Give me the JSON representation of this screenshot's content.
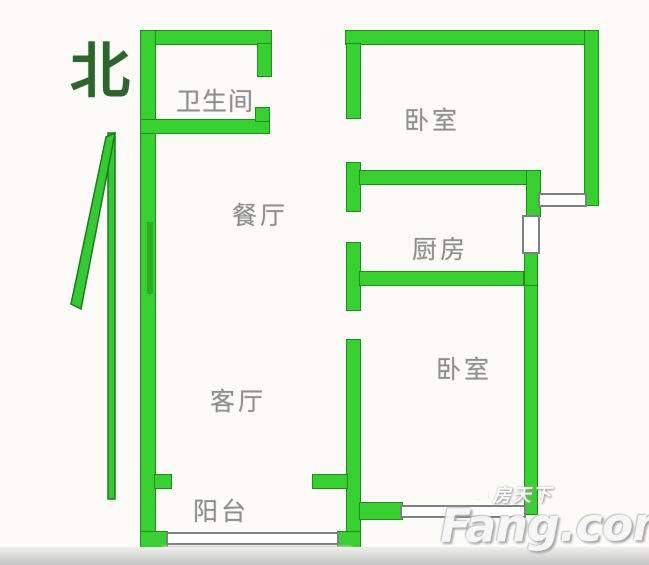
{
  "compass": {
    "north_label": "北"
  },
  "rooms": {
    "bathroom": {
      "label": "卫生间"
    },
    "bedroom_top": {
      "label": "卧室"
    },
    "dining": {
      "label": "餐厅"
    },
    "kitchen": {
      "label": "厨房"
    },
    "bedroom_bottom": {
      "label": "卧室"
    },
    "living": {
      "label": "客厅"
    },
    "balcony": {
      "label": "阳台"
    }
  },
  "watermark": {
    "brand_cn": "房天下",
    "brand_en": "Fang.com"
  },
  "colors": {
    "wall_fill": "#38cf31",
    "wall_edge": "#1f8c1f",
    "room_label_gray": "#8f8f8f",
    "compass_green": "#2e652e",
    "window_line_gray": "#808080"
  }
}
